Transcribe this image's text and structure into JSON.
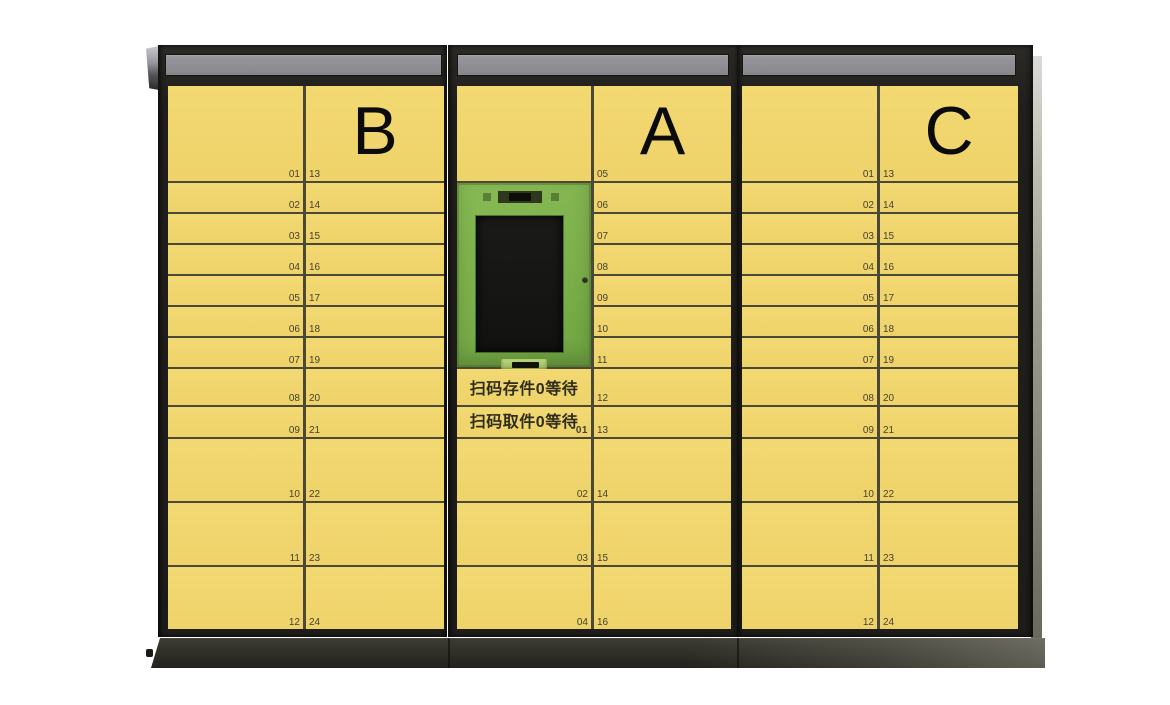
{
  "machine": {
    "title": "smart-parcel-locker",
    "colors": {
      "door_yellow": "#f1d76f",
      "divider_olive": "#4c4838",
      "frame_dark": "#201f1c",
      "sign_gray": "#8c8c91",
      "panel_green": "#7cb04a",
      "screen_black": "#141414",
      "base_dark": "#32312a",
      "number_text": "#45422f",
      "letter_text": "#0b0b0b"
    },
    "cabinets": {
      "b": {
        "label": "B",
        "left_numbers": [
          "01",
          "02",
          "03",
          "04",
          "05",
          "06",
          "07",
          "08",
          "09",
          "10",
          "11",
          "12"
        ],
        "right_numbers": [
          "13",
          "14",
          "15",
          "16",
          "17",
          "18",
          "19",
          "20",
          "21",
          "22",
          "23",
          "24"
        ]
      },
      "a": {
        "label": "A",
        "left_numbers": [
          "01",
          "02",
          "03",
          "04"
        ],
        "right_numbers": [
          "05",
          "06",
          "07",
          "08",
          "09",
          "10",
          "11",
          "12",
          "13",
          "14",
          "15",
          "16"
        ]
      },
      "c": {
        "label": "C",
        "left_numbers": [
          "01",
          "02",
          "03",
          "04",
          "05",
          "06",
          "07",
          "08",
          "09",
          "10",
          "11",
          "12"
        ],
        "right_numbers": [
          "13",
          "14",
          "15",
          "16",
          "17",
          "18",
          "19",
          "20",
          "21",
          "22",
          "23",
          "24"
        ]
      }
    },
    "console": {
      "deposit_status": "扫码存件0等待",
      "pickup_status": "扫码取件0等待"
    }
  }
}
